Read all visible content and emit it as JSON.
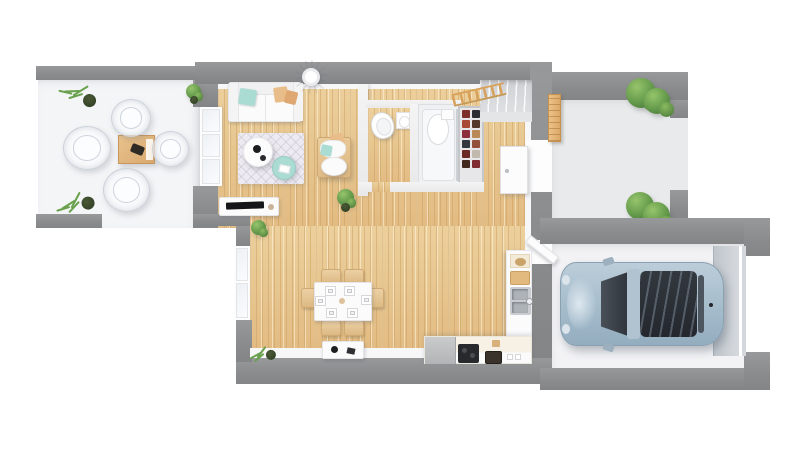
{
  "palette": {
    "background": "#ffffff",
    "wall": "#8b8c8e",
    "inner-face": "#f7f7f8",
    "wood-a": "#ecd09c",
    "wood-b": "#e2bb82",
    "terrace-floor": "#f4f5f7",
    "porch-floor": "#e9eaec",
    "garage-floor": "#f3f3f5",
    "garage-door": "#c9ced3",
    "car-body": "#abbfce",
    "car-glass": "#32373e",
    "rug": "#edebf1",
    "teal": "#aadcd4",
    "tan": "#e9bd8a",
    "chair-wood": "#e3c193",
    "plant": "#69a14d",
    "white-furniture": "#fbfbfb"
  },
  "scene": {
    "type": "3d-floor-plan-top-down-render",
    "text_content": "none — image contains no visible text or UI labels",
    "rooms": [
      {
        "name": "terrace",
        "floor": "white-stone",
        "objects": [
          "outdoor-dining-table",
          "ghost-chair",
          "ghost-chair",
          "ghost-chair",
          "ghost-chair",
          "potted-plant",
          "potted-plant",
          "potted-plant"
        ]
      },
      {
        "name": "living-room",
        "floor": "wood",
        "objects": [
          "sofa",
          "teal-pillow",
          "tan-pillows",
          "floor-lamp",
          "patterned-rug",
          "round-coffee-table",
          "teal-side-table",
          "armchair-with-pouf",
          "houseplant",
          "tv-stand",
          "tv"
        ]
      },
      {
        "name": "wc",
        "floor": "wood",
        "objects": [
          "toilet",
          "toilet-paper-holder"
        ]
      },
      {
        "name": "shower-room",
        "floor": "white-tray",
        "objects": [
          "shower-tray",
          "toilet",
          "shelf-box"
        ]
      },
      {
        "name": "hallway",
        "floor": "wood",
        "objects": [
          "staircase",
          "wood-railing",
          "shoe-rack"
        ]
      },
      {
        "name": "dining-area",
        "floor": "wood",
        "objects": [
          "dining-table",
          "six-dining-chairs",
          "six-place-settings",
          "sideboard",
          "houseplant"
        ]
      },
      {
        "name": "kitchen",
        "floor": "wood",
        "objects": [
          "sink-counter",
          "double-sink",
          "cutting-board",
          "shelf-bowl",
          "appliance",
          "cooktop",
          "basket",
          "jars"
        ]
      },
      {
        "name": "entry-porch",
        "floor": "gray-stone",
        "objects": [
          "wood-bench",
          "bush",
          "bush",
          "front-door"
        ]
      },
      {
        "name": "garage",
        "floor": "concrete",
        "objects": [
          "car",
          "garage-door",
          "access-door"
        ]
      }
    ],
    "car": {
      "color": "light-blue-gray",
      "orientation": "parked-facing-left",
      "features": [
        "windshield",
        "panoramic-roof",
        "side-mirrors"
      ]
    }
  }
}
